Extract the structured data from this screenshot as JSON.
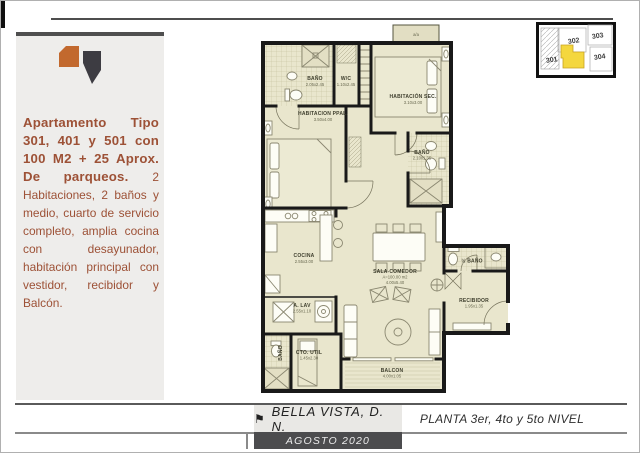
{
  "sidebar": {
    "heading": "Apartamento Tipo 301, 401 y 501 con 100 M2 + 25 Aprox. De parqueos.",
    "body": "2 Habitaciones, 2 baños y medio, cuarto de servicio completo, amplia cocina con desayunador, habitación principal con vestidor, recibidor y Balcón.",
    "text_color": "#9d5136",
    "logo_orange": "#c2692e",
    "logo_dark": "#3d3c42"
  },
  "keyplan": {
    "units": [
      "301",
      "302",
      "303",
      "304"
    ],
    "highlight_color": "#f4d73e"
  },
  "plan": {
    "rooms": {
      "bath1": {
        "name": "BAÑO",
        "dims": "2.05x2.45"
      },
      "wc": {
        "name": "W/C",
        "dims": "1.10x2.45"
      },
      "habsec": {
        "name": "HABITACIÓN SEC.",
        "dims": "3.10x3.00"
      },
      "habppal": {
        "name": "HABITACION PPAL.",
        "dims": "3.50x4.00"
      },
      "bath2": {
        "name": "BAÑO",
        "dims": "2.10x1.35"
      },
      "cocina": {
        "name": "COCINA",
        "dims": "2.55x3.00"
      },
      "sala": {
        "name": "SALA-COMEDOR",
        "area": "A=100.00 m2",
        "dims": "4.00x5.40"
      },
      "alav": {
        "name": "A. LAV",
        "dims": "2.55x1.10"
      },
      "ctoutil": {
        "name": "CTO. UTIL",
        "dims": "1.45x2.30"
      },
      "bath3": {
        "name": "BAÑO"
      },
      "balcon": {
        "name": "BALCON",
        "dims": "4.00x1.05"
      },
      "recibidor": {
        "name": "RECIBIDOR",
        "dims": "1.95x1.35"
      },
      "halfbath": {
        "name": "½ BAÑO"
      },
      "aa": {
        "name": "a/a"
      }
    }
  },
  "footer": {
    "flag": "⚑",
    "project": "BELLA VISTA, D. N.",
    "date": "AGOSTO 2020",
    "plan_title": "PLANTA 3er, 4to y 5to NIVEL"
  }
}
